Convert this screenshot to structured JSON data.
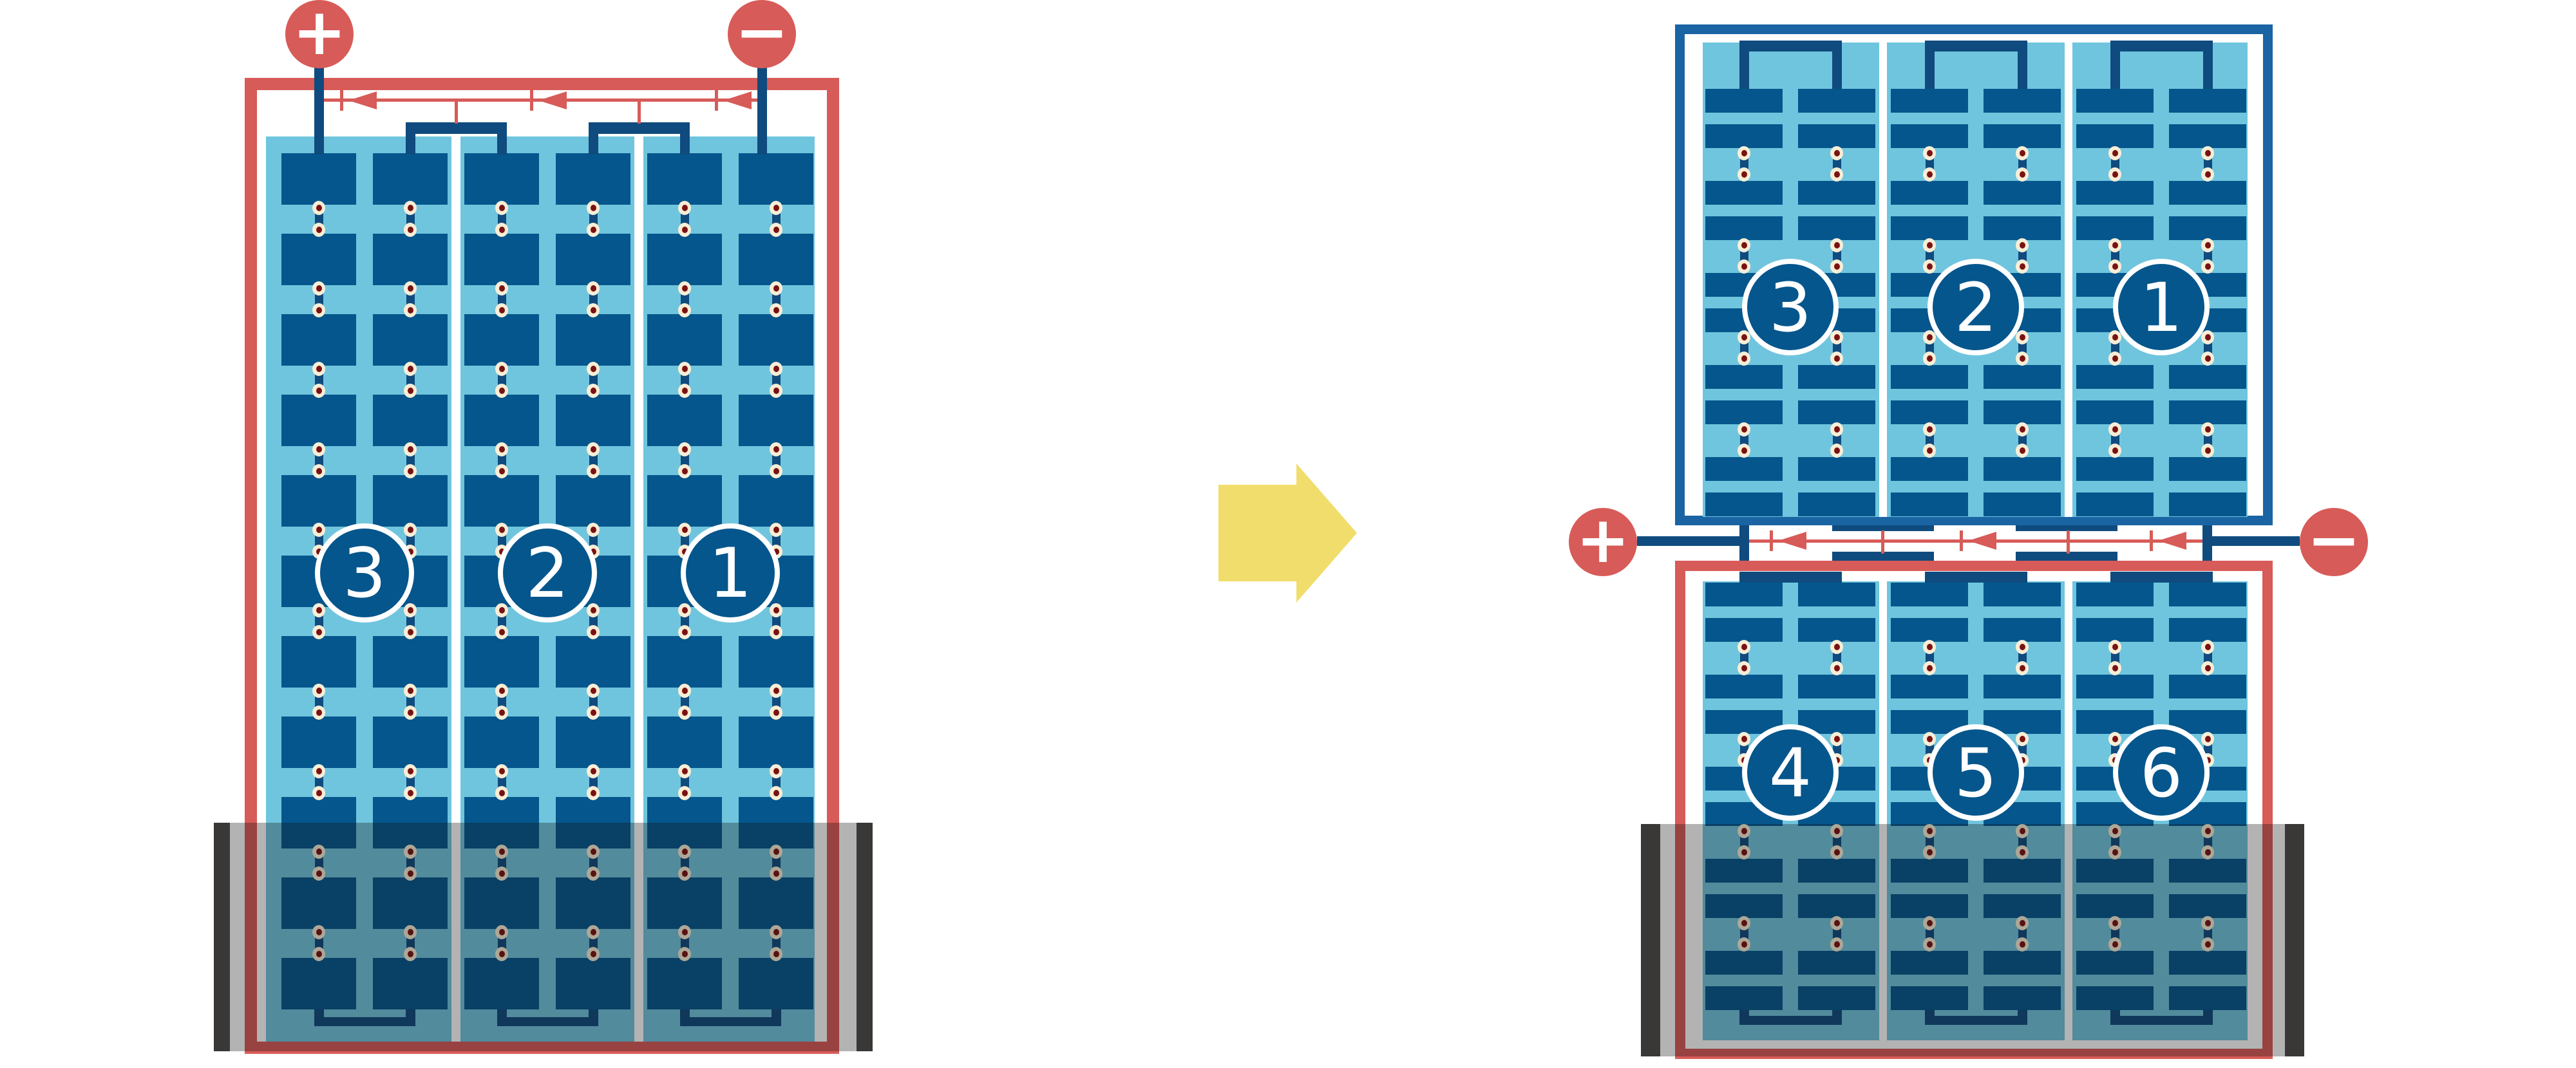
{
  "left_panel": {
    "type": "full-cell-panel-series-strings",
    "terminals": {
      "positive": "+",
      "negative": "−"
    },
    "strings": [
      {
        "label": "3"
      },
      {
        "label": "2"
      },
      {
        "label": "1"
      }
    ],
    "bypass_diode_count": 3,
    "shaded_bottom": true
  },
  "right_panel": {
    "type": "half-cut-cell-panel",
    "terminals": {
      "positive": "+",
      "negative": "−"
    },
    "top_half": {
      "strings": [
        {
          "label": "3"
        },
        {
          "label": "2"
        },
        {
          "label": "1"
        }
      ]
    },
    "bottom_half": {
      "strings": [
        {
          "label": "4"
        },
        {
          "label": "5"
        },
        {
          "label": "6"
        }
      ]
    },
    "bypass_diode_count": 3,
    "shaded_bottom": true
  },
  "icons": {
    "transform_arrow": "right-arrow",
    "positive_terminal": "plus-circle",
    "negative_terminal": "minus-circle",
    "bypass_diode": "left-pointing-diode-symbol",
    "cell_interconnect": "solder-dot-pair",
    "shade": "translucent-gray-overlay"
  },
  "colors": {
    "red": "#d75b58",
    "cell_blue": "#05568c",
    "wire_blue": "#0f4b7e",
    "frame_blue": "#1a64a4",
    "light_blue": "#70c5de",
    "cream": "#f8eed6",
    "dot_red": "#7a1212",
    "charcoal": "#3a3837",
    "arrow_yellow": "#f1dd6c",
    "background": "#ffffff",
    "shade_overlay": "rgba(20,18,18,0.32)"
  }
}
